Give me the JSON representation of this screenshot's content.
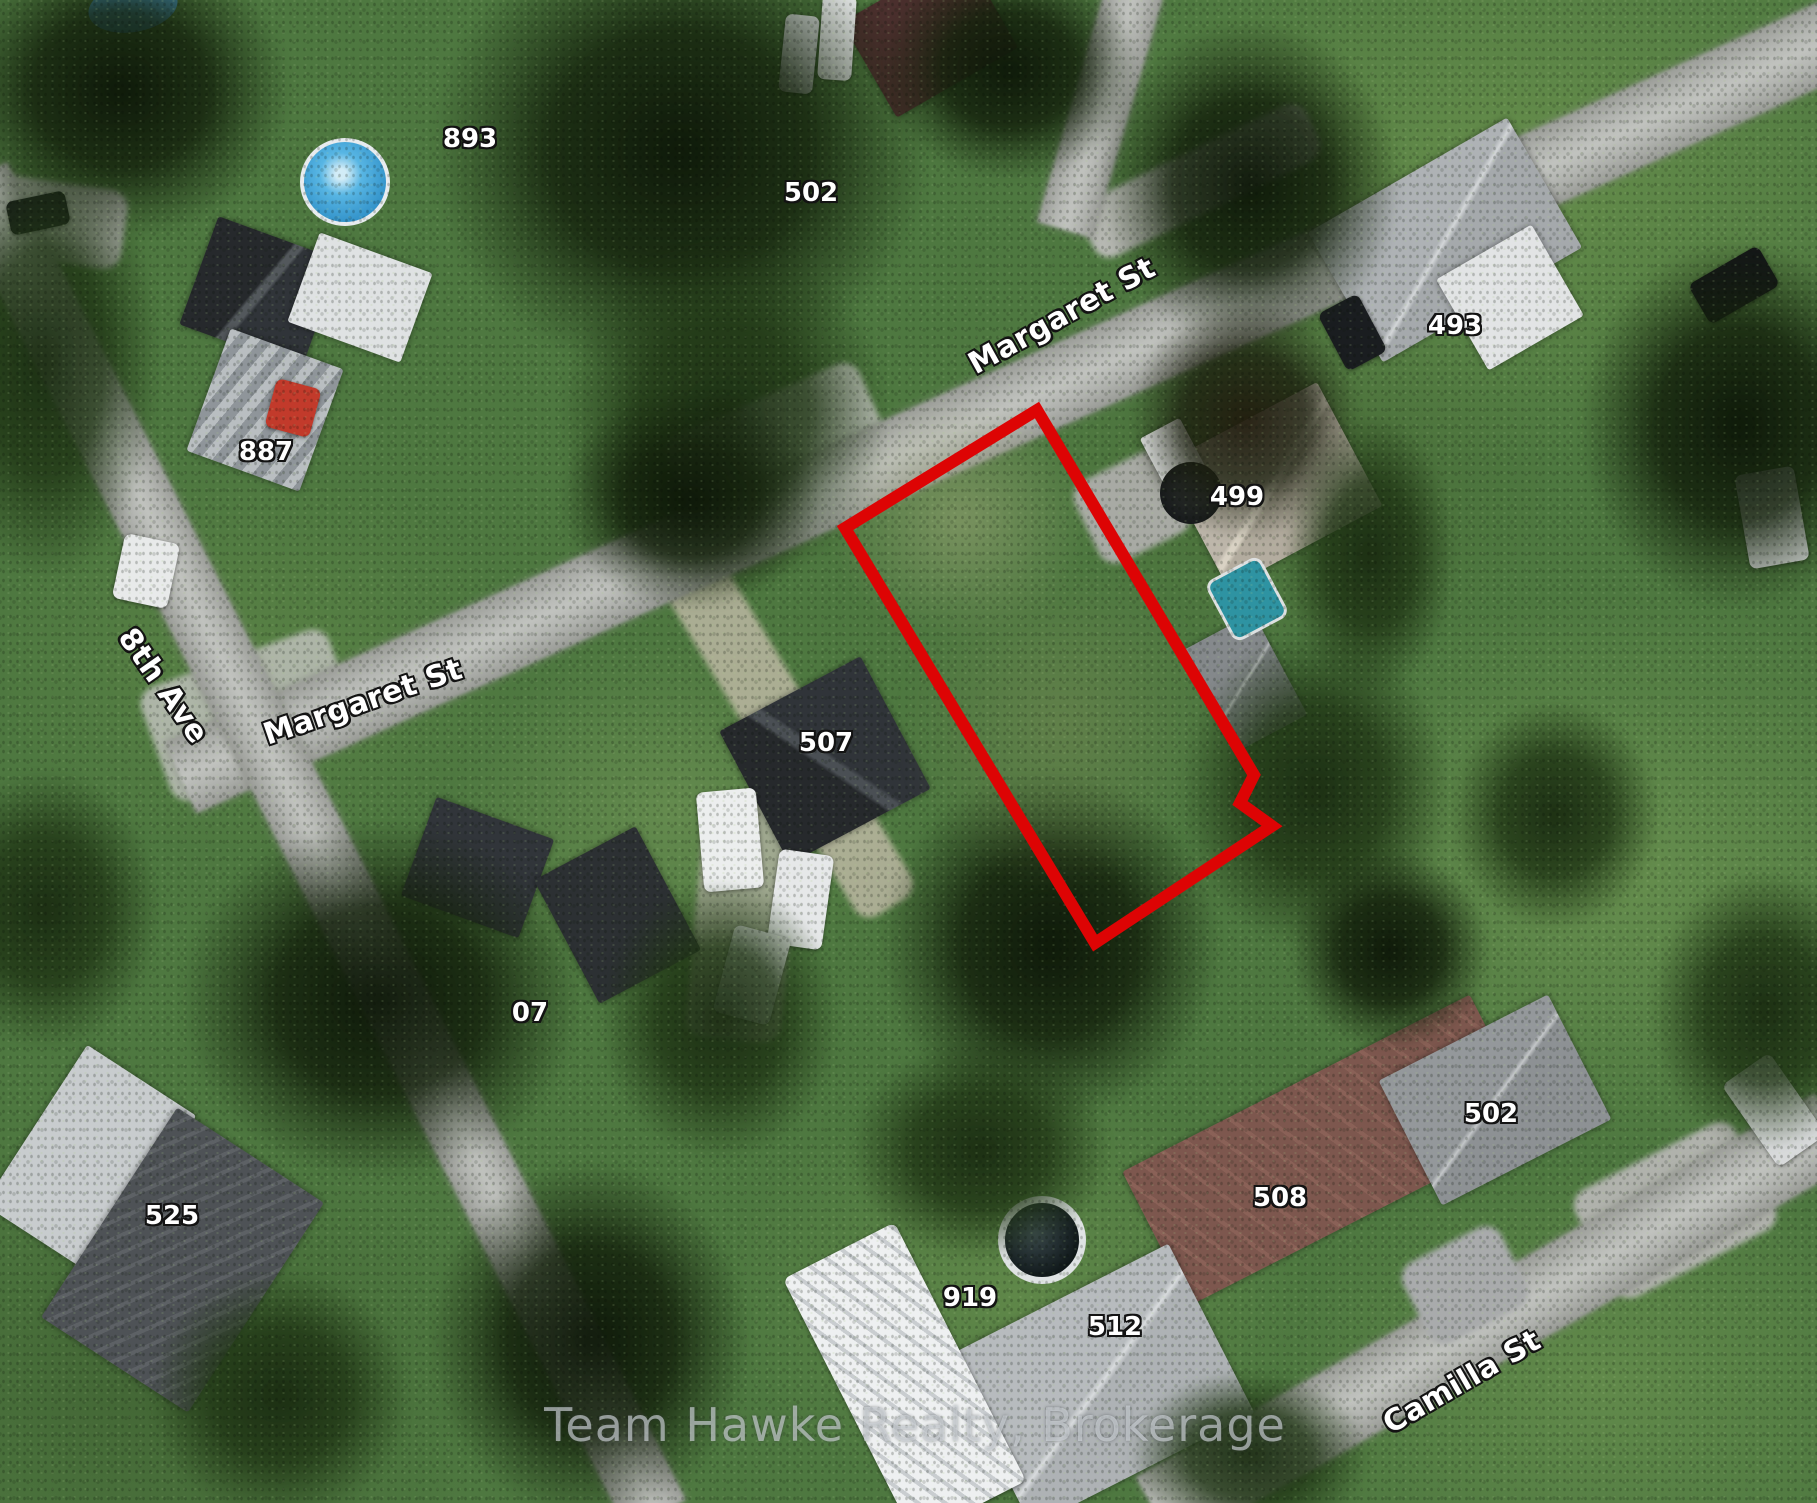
{
  "map": {
    "description": "Satellite aerial photo of a residential neighbourhood with a vacant lot outlined in red",
    "watermark": "Team Hawke Realty, Brokerage",
    "street_labels": [
      {
        "text": "Margaret St",
        "x": 1062,
        "y": 316,
        "rotation": -29
      },
      {
        "text": "Margaret St",
        "x": 363,
        "y": 702,
        "rotation": -19
      },
      {
        "text": "8th Ave",
        "x": 163,
        "y": 686,
        "rotation": 55
      },
      {
        "text": "Camilla St",
        "x": 1462,
        "y": 1382,
        "rotation": -30
      }
    ],
    "house_numbers": [
      {
        "text": "893",
        "x": 470,
        "y": 139
      },
      {
        "text": "502",
        "x": 811,
        "y": 193
      },
      {
        "text": "493",
        "x": 1455,
        "y": 326
      },
      {
        "text": "887",
        "x": 266,
        "y": 452
      },
      {
        "text": "499",
        "x": 1237,
        "y": 497
      },
      {
        "text": "507",
        "x": 826,
        "y": 743
      },
      {
        "text": "07",
        "x": 530,
        "y": 1013
      },
      {
        "text": "525",
        "x": 172,
        "y": 1216
      },
      {
        "text": "502",
        "x": 1491,
        "y": 1114
      },
      {
        "text": "508",
        "x": 1280,
        "y": 1198
      },
      {
        "text": "919",
        "x": 970,
        "y": 1298
      },
      {
        "text": "512",
        "x": 1115,
        "y": 1327
      }
    ],
    "lot_boundary": {
      "color": "#dd0404",
      "stroke_width": 12,
      "points": [
        [
          845,
          528
        ],
        [
          1037,
          410
        ],
        [
          1254,
          775
        ],
        [
          1240,
          803
        ],
        [
          1272,
          826
        ],
        [
          1095,
          943
        ]
      ]
    }
  }
}
